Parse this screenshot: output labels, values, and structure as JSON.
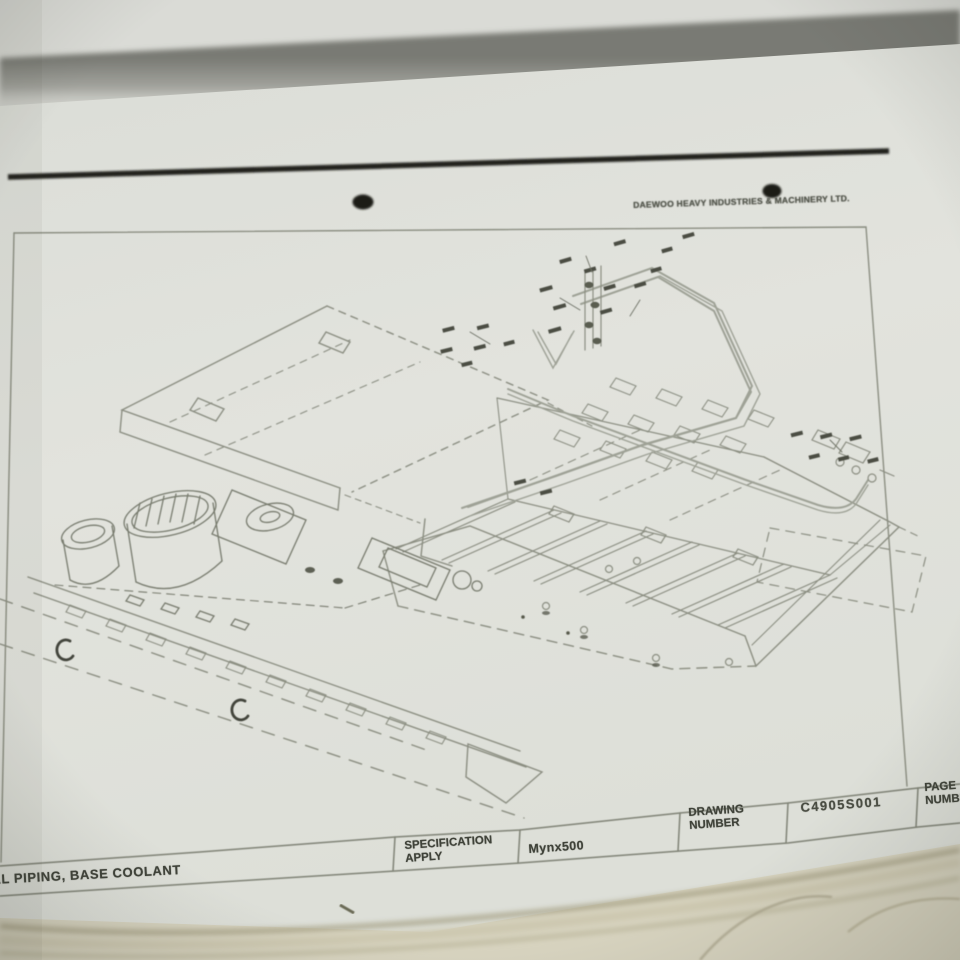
{
  "document": {
    "company_header": "DAEWOO HEAVY INDUSTRIES & MACHINERY LTD.",
    "figure": "isometric line drawing of machine base with external coolant piping",
    "title_block": {
      "drawing_title": "AL PIPING, BASE COOLANT",
      "specification_label": [
        "SPECIFICATION",
        "APPLY"
      ],
      "specification_value": "Mynx500",
      "drawing_number_label": [
        "DRAWING",
        "NUMBER"
      ],
      "drawing_number_value": "C4905S001",
      "page_number_label": [
        "PAGE",
        "NUMBER"
      ]
    },
    "colors": {
      "paper": "#e0e1db",
      "under_pages": "#d7d3bd",
      "print_line": "#8b8e80",
      "ink": "#20211c",
      "shadow_band": "#83847d"
    }
  }
}
